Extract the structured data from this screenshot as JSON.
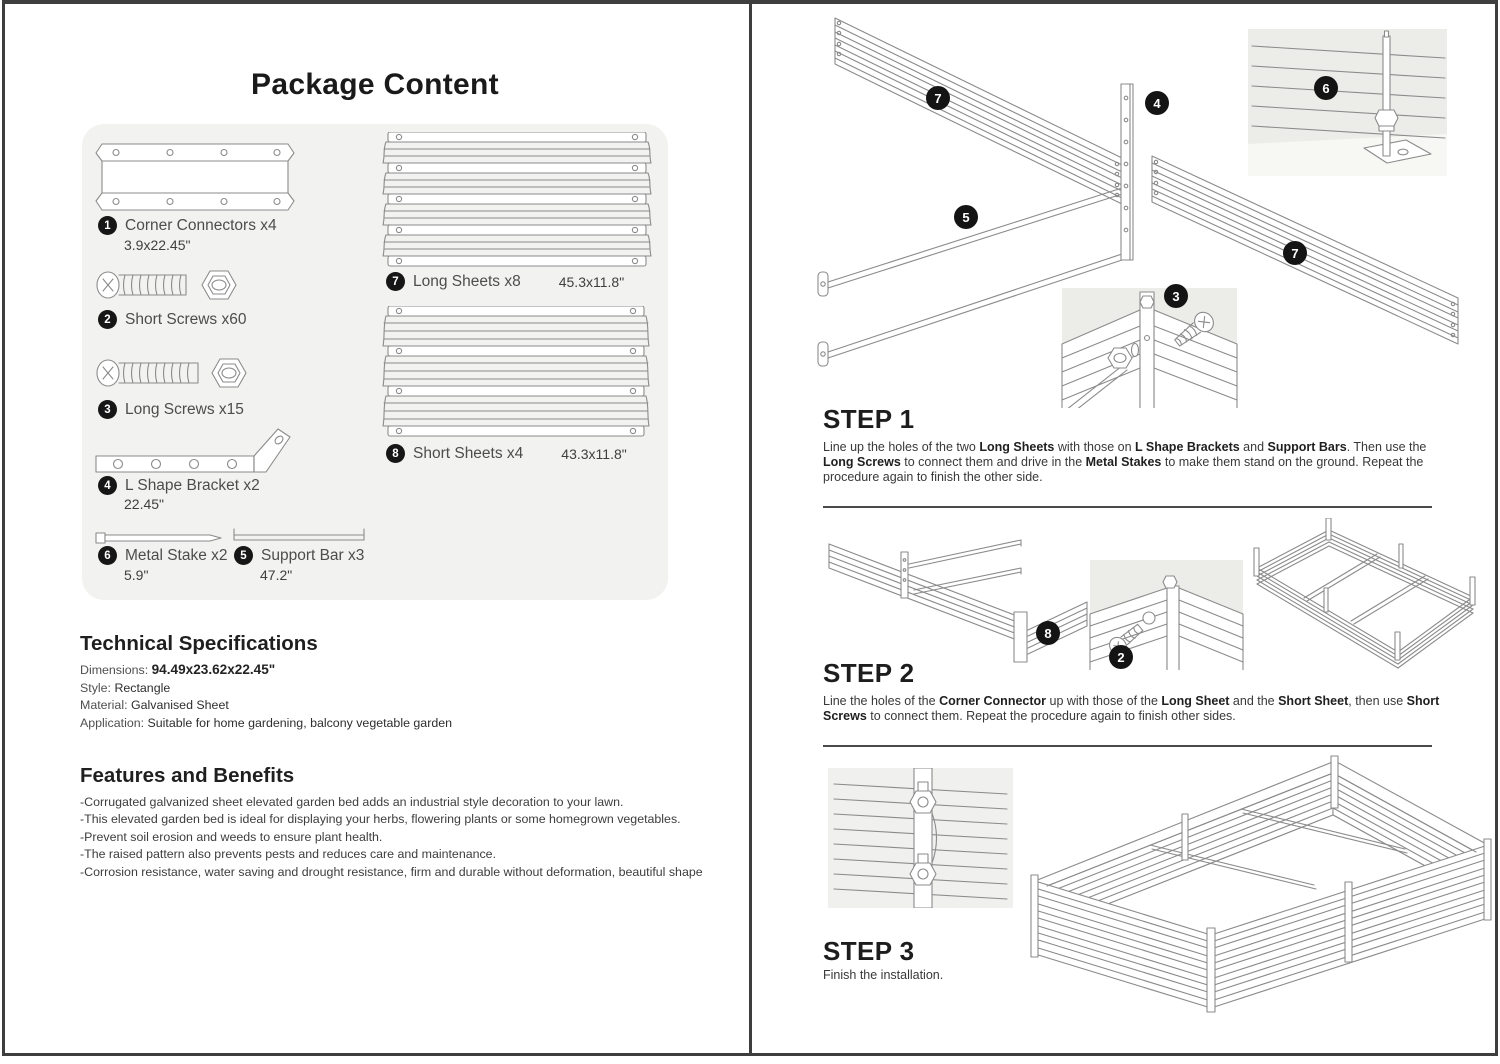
{
  "package": {
    "title": "Package Content",
    "items": [
      {
        "num": "1",
        "label": "Corner Connectors x4",
        "dim": "3.9x22.45\""
      },
      {
        "num": "2",
        "label": "Short Screws x60",
        "dim": ""
      },
      {
        "num": "3",
        "label": "Long Screws x15",
        "dim": ""
      },
      {
        "num": "4",
        "label": "L Shape Bracket x2",
        "dim": "22.45\""
      },
      {
        "num": "6",
        "label": "Metal Stake x2",
        "dim": "5.9\""
      },
      {
        "num": "5",
        "label": "Support Bar x3",
        "dim": "47.2\""
      },
      {
        "num": "7",
        "label": "Long Sheets x8",
        "dim": "45.3x11.8\""
      },
      {
        "num": "8",
        "label": "Short Sheets x4",
        "dim": "43.3x11.8\""
      }
    ]
  },
  "specs": {
    "title": "Technical Specifications",
    "rows": [
      {
        "label": "Dimensions: ",
        "value": "94.49x23.62x22.45\""
      },
      {
        "label": "Style: ",
        "value": "Rectangle"
      },
      {
        "label": "Material: ",
        "value": "Galvanised Sheet"
      },
      {
        "label": "Application: ",
        "value": "Suitable for home gardening, balcony vegetable garden"
      }
    ]
  },
  "features": {
    "title": "Features and Benefits",
    "bullets": [
      "-Corrugated galvanized sheet elevated garden bed adds an industrial style decoration to your lawn.",
      "-This elevated garden bed is ideal for displaying your herbs, flowering plants or some homegrown vegetables.",
      "-Prevent soil erosion and weeds to ensure plant health.",
      "-The raised pattern also prevents pests and reduces care and maintenance.",
      "-Corrosion resistance, water saving and drought resistance, firm and durable without deformation, beautiful shape"
    ]
  },
  "steps": [
    {
      "title": "STEP 1",
      "callouts": [
        "7",
        "4",
        "6",
        "5",
        "3",
        "7"
      ],
      "body": [
        {
          "t": "Line up the holes of the two ",
          "b": 0
        },
        {
          "t": "Long Sheets",
          "b": 1
        },
        {
          "t": " with those on ",
          "b": 0
        },
        {
          "t": "L Shape Brackets",
          "b": 1
        },
        {
          "t": " and ",
          "b": 0
        },
        {
          "t": "Support Bars",
          "b": 1
        },
        {
          "t": ". Then use the ",
          "b": 0
        },
        {
          "t": "Long Screws",
          "b": 1
        },
        {
          "t": " to connect them and drive in the ",
          "b": 0
        },
        {
          "t": "Metal Stakes",
          "b": 1
        },
        {
          "t": " to make them stand on the ground. Repeat the procedure again to finish the other side.",
          "b": 0
        }
      ]
    },
    {
      "title": "STEP 2",
      "callouts": [
        "8",
        "2"
      ],
      "body": [
        {
          "t": "Line the holes of the ",
          "b": 0
        },
        {
          "t": "Corner Connector",
          "b": 1
        },
        {
          "t": " up with those of the ",
          "b": 0
        },
        {
          "t": "Long Sheet",
          "b": 1
        },
        {
          "t": " and the ",
          "b": 0
        },
        {
          "t": "Short Sheet",
          "b": 1
        },
        {
          "t": ", then use ",
          "b": 0
        },
        {
          "t": "Short Screws",
          "b": 1
        },
        {
          "t": " to connect them. Repeat the procedure again to finish other sides.",
          "b": 0
        }
      ]
    },
    {
      "title": "STEP 3",
      "callouts": [],
      "body": [
        {
          "t": "Finish the installation.",
          "b": 0
        }
      ]
    }
  ],
  "colors": {
    "line": "#8b8b8b",
    "frame": "#3e3e3e",
    "panel_bg": "#f2f2f0",
    "inset_bg": "#ecece9",
    "callout_bg": "#141414",
    "callout_fg": "#ffffff"
  }
}
